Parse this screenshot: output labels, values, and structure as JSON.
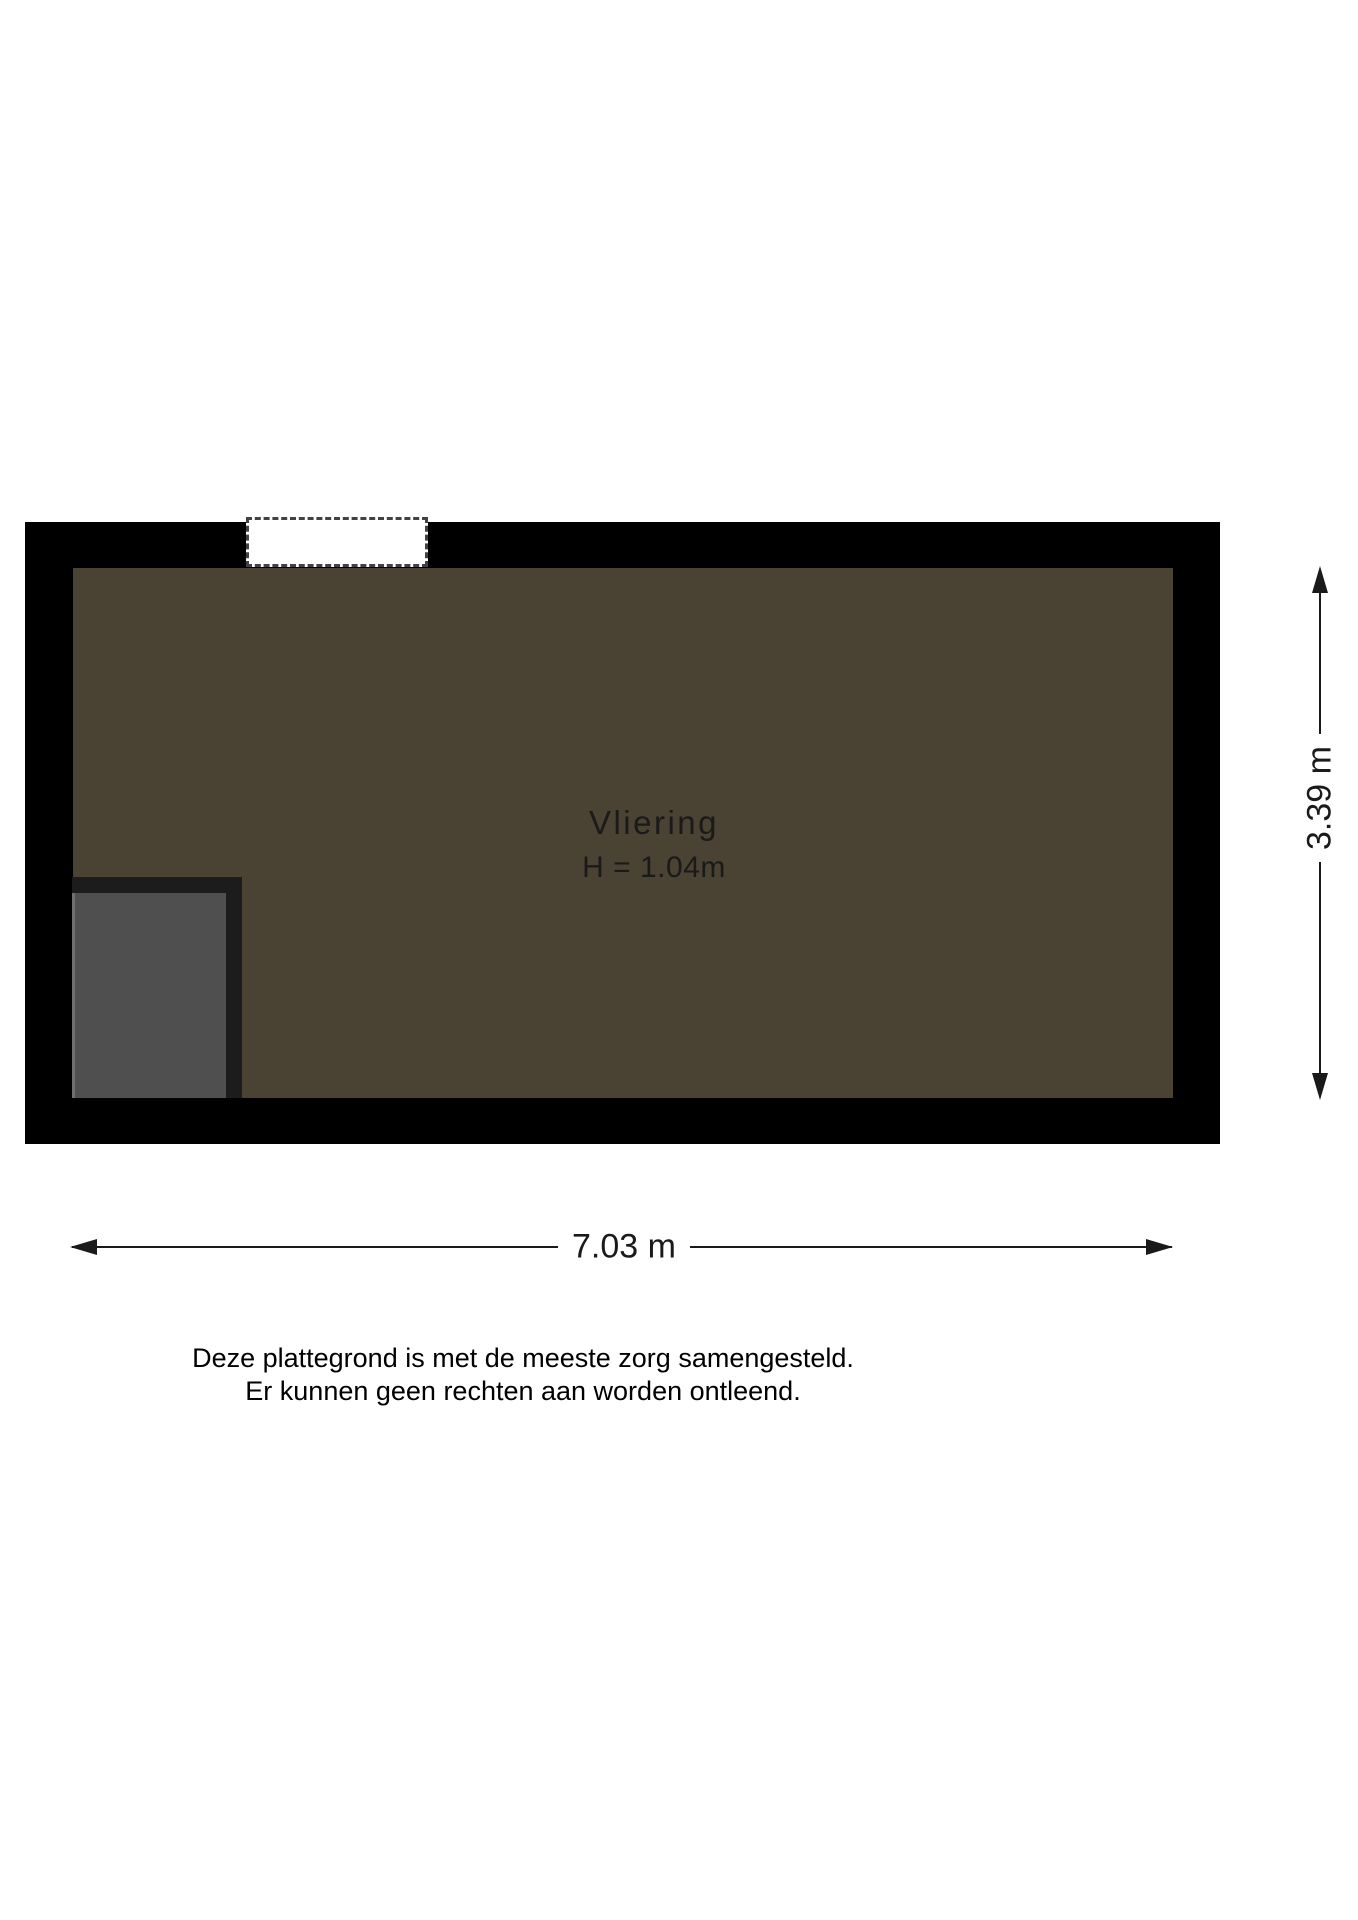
{
  "floorplan": {
    "room_label": "Vliering",
    "room_height_label": "H = 1.04m",
    "width_dimension": "7.03 m",
    "height_dimension": "3.39 m"
  },
  "disclaimer": {
    "line1": "Deze plattegrond is met de meeste zorg samengesteld.",
    "line2": "Er kunnen geen rechten aan worden ontleend."
  },
  "icons": [
    "arrow-up-icon",
    "arrow-down-icon",
    "arrow-left-icon",
    "arrow-right-icon"
  ],
  "colors": {
    "background": "#FFFFFF",
    "wall": "#000000",
    "room_fill": "#4A4233",
    "room_text": "#1A1A1A",
    "window_dash": "#424242",
    "stair_frame": "#1C1C1C",
    "stair_fill": "#4F4F4F",
    "stair_highlight": "#6F6F6F",
    "dimension": "#1A1A1A"
  }
}
